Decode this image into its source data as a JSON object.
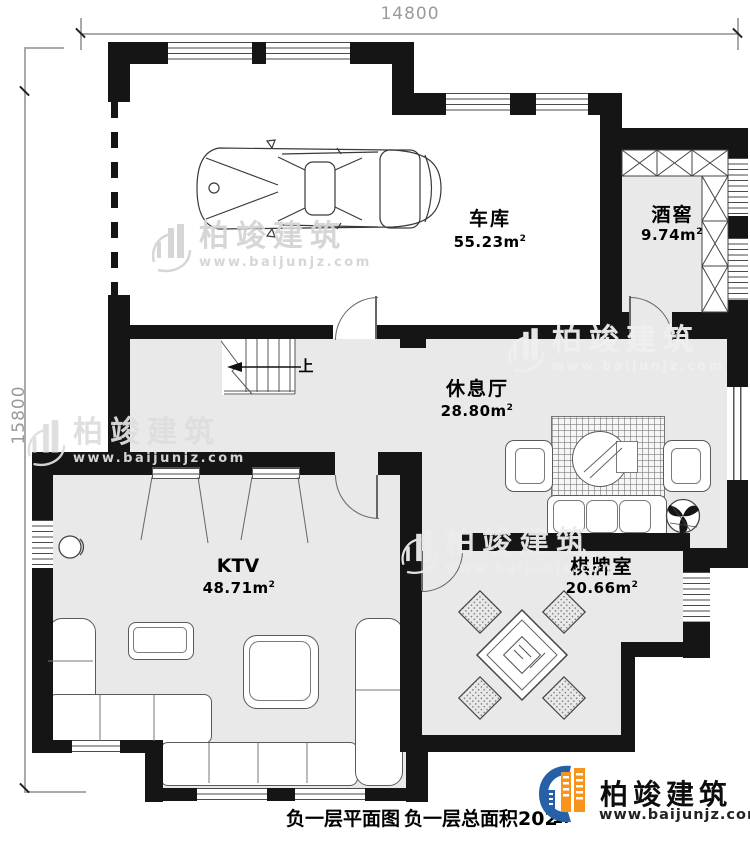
{
  "colors": {
    "wall": "#151515",
    "floor": "#e9e9e9",
    "logo_blue": "#2661a7",
    "logo_orange": "#f7941d",
    "dim_text": "#9a9a9a"
  },
  "dimensions": {
    "top_width": "14800",
    "left_height": "15800"
  },
  "rooms": {
    "garage": {
      "name": "车库",
      "area": "55.23",
      "unit": "m",
      "sup": "2"
    },
    "cellar": {
      "name": "酒窖",
      "area": "9.74",
      "unit": "m",
      "sup": "2"
    },
    "lounge": {
      "name": "休息厅",
      "area": "28.80",
      "unit": "m",
      "sup": "2"
    },
    "ktv": {
      "name": "KTV",
      "area": "48.71",
      "unit": "m",
      "sup": "2"
    },
    "chess": {
      "name": "棋牌室",
      "area": "20.66",
      "unit": "m",
      "sup": "2"
    }
  },
  "stairs": {
    "up_label": "上"
  },
  "caption": {
    "plan_title": "负一层平面图",
    "total_area": "负一层总面积202",
    "scale_prefix": "1:"
  },
  "brand": {
    "name": "柏竣建筑",
    "url": "www.baijunjz.com"
  },
  "watermark": {
    "name": "柏竣建筑",
    "url": "www.baijunjz.com"
  }
}
